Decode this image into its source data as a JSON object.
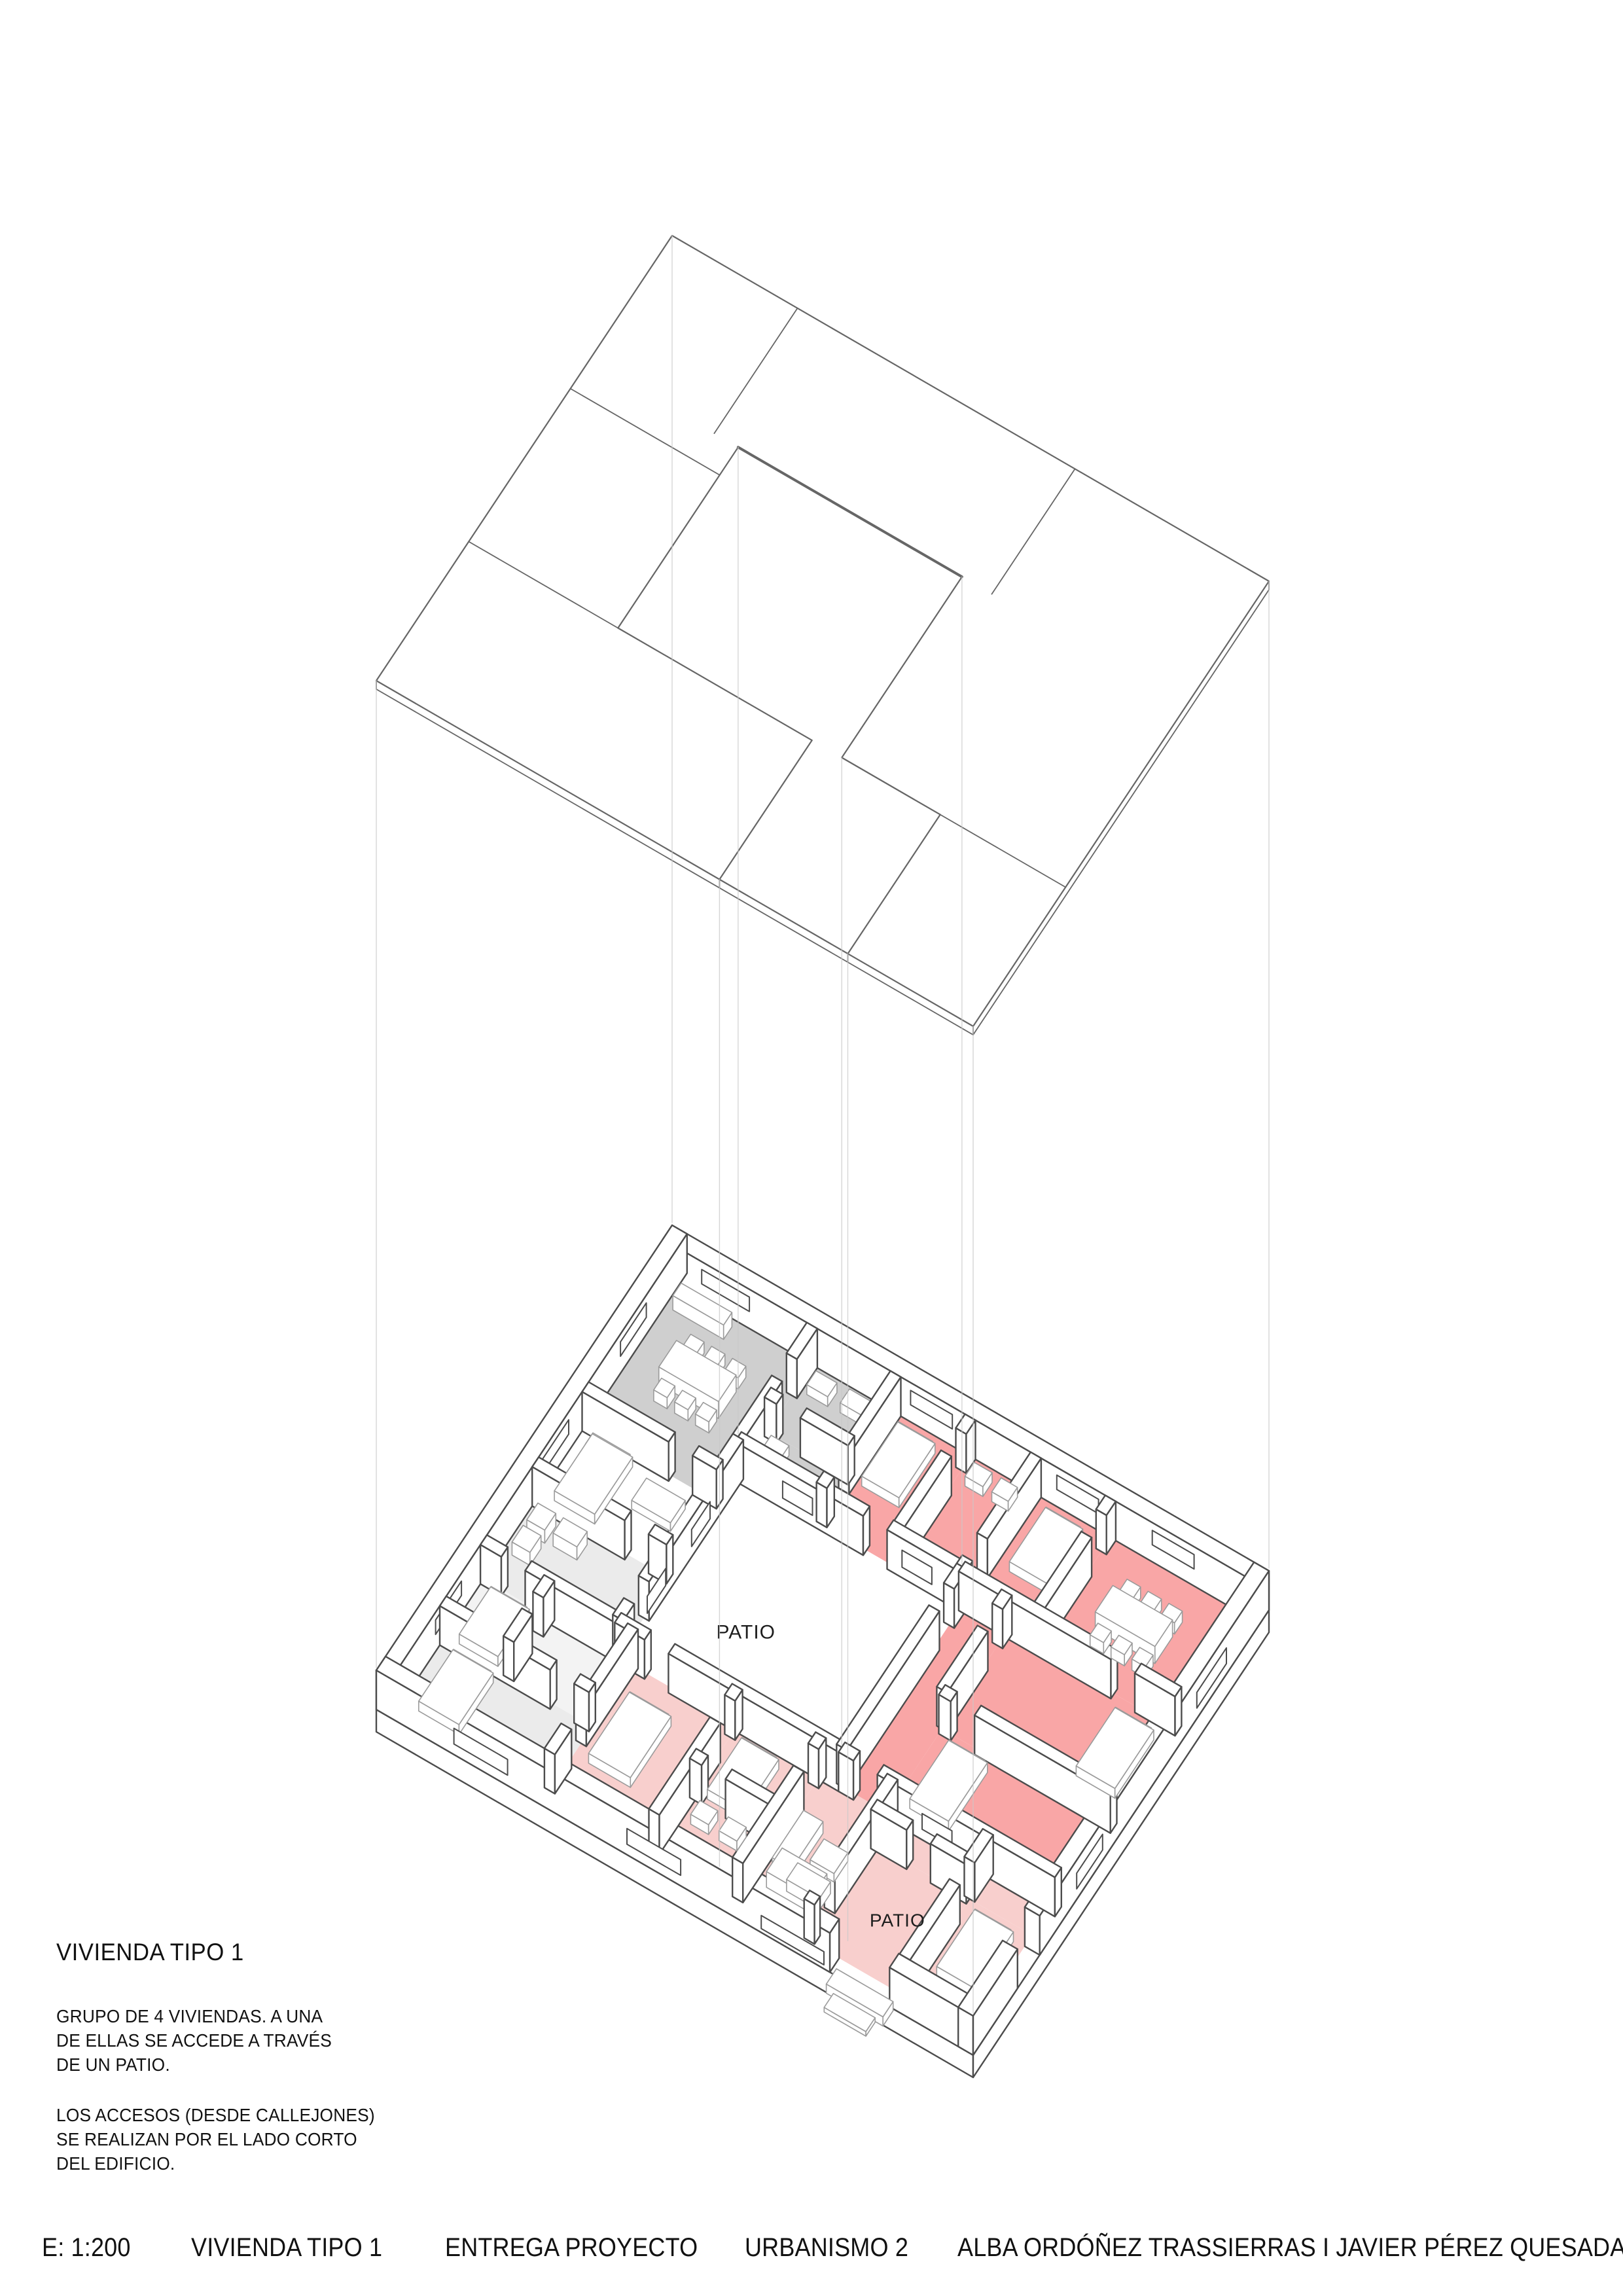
{
  "annotation": {
    "title": "VIVIENDA TIPO 1",
    "body1": "GRUPO DE 4 VIVIENDAS. A UNA\nDE ELLAS SE ACCEDE A TRAVÉS\nDE UN PATIO.",
    "body2": "LOS ACCESOS (DESDE CALLEJONES)\nSE REALIZAN POR EL LADO CORTO\nDEL EDIFICIO."
  },
  "footer": {
    "items": [
      "E: 1:200",
      "VIVIENDA TIPO 1",
      "ENTREGA PROYECTO",
      "URBANISMO 2",
      "ALBA ORDÓÑEZ TRASSIERRAS I JAVIER PÉREZ QUESADA"
    ]
  },
  "labels": {
    "patio_main": "PATIO",
    "patio_entry": "PATIO"
  },
  "colors": {
    "wall_line": "#4c4c4c",
    "roof_line": "#666666",
    "furniture_line": "#9b9b9b",
    "projection_line": "#c9c9c9",
    "floor_gray": "#cfcfcf",
    "floor_lightgray": "#ebebeb",
    "floor_lightgray2": "#f3f3f3",
    "floor_red": "#f9a6a6",
    "floor_pink": "#f8cfcd",
    "paper": "#ffffff",
    "text": "#1d1d1d"
  },
  "scene": {
    "proj": {
      "origin": [
        1027,
        1932
      ],
      "ax": [
        45.6,
        26.4
      ],
      "ay": [
        -28.25,
        42.5
      ],
      "roof_rise": 1572,
      "wall_h": 60,
      "slab": 34
    },
    "roof": {
      "outer": [
        [
          0,
          0
        ],
        [
          20,
          0
        ],
        [
          20,
          16
        ],
        [
          0,
          16
        ]
      ],
      "hole": [
        [
          5,
          4.5
        ],
        [
          12.5,
          4.5
        ],
        [
          12.5,
          11
        ],
        [
          15.8,
          11
        ],
        [
          15.8,
          16
        ],
        [
          11.5,
          16
        ],
        [
          11.5,
          11
        ],
        [
          5,
          11
        ]
      ],
      "divisions": [
        [
          4.2,
          0,
          4.2,
          4.5
        ],
        [
          0,
          5.5,
          5,
          5.5
        ],
        [
          0,
          11,
          5,
          11
        ],
        [
          13.5,
          0,
          13.5,
          4.5
        ],
        [
          12.5,
          11,
          20,
          11
        ]
      ],
      "heavy_edge": [
        5,
        4.5,
        12.5,
        4.5
      ],
      "thick": 13
    },
    "verticals": [
      [
        0,
        0
      ],
      [
        20,
        0
      ],
      [
        0,
        16
      ],
      [
        20,
        16
      ],
      [
        5,
        4.5
      ],
      [
        12.5,
        4.5
      ],
      [
        11.5,
        16
      ],
      [
        15.8,
        16
      ],
      [
        12.5,
        11
      ]
    ],
    "floors": [
      {
        "c": "floor_gray",
        "r": [
          0.5,
          0.5,
          5,
          5.5
        ]
      },
      {
        "c": "floor_gray",
        "r": [
          5,
          0.5,
          7.8,
          2.9
        ]
      },
      {
        "c": "floor_gray",
        "r": [
          5,
          2.9,
          7.8,
          4.5
        ]
      },
      {
        "c": "floor_lightgray",
        "r": [
          0.5,
          8.2,
          5,
          11
        ]
      },
      {
        "c": "floor_lightgray2",
        "r": [
          0.5,
          11,
          5.5,
          13.2
        ]
      },
      {
        "c": "floor_lightgray",
        "r": [
          0.5,
          13.2,
          5.5,
          15.5
        ]
      },
      {
        "c": "floor_red",
        "r": [
          7.8,
          0.5,
          10.3,
          4.5
        ]
      },
      {
        "c": "floor_red",
        "r": [
          10.3,
          0.5,
          12.5,
          4.5
        ]
      },
      {
        "c": "floor_red",
        "r": [
          12.5,
          0.5,
          15,
          4.5
        ]
      },
      {
        "c": "floor_red",
        "r": [
          15,
          0.5,
          19.5,
          4.5
        ]
      },
      {
        "c": "floor_red",
        "r": [
          12.5,
          4.5,
          14,
          11
        ]
      },
      {
        "c": "floor_red",
        "r": [
          14,
          4.5,
          19.5,
          8
        ]
      },
      {
        "c": "floor_red",
        "r": [
          14,
          8,
          19.5,
          11
        ]
      },
      {
        "c": "floor_pink",
        "r": [
          5.5,
          11,
          9,
          15.5
        ]
      },
      {
        "c": "floor_pink",
        "r": [
          9,
          11,
          11.8,
          13.4
        ]
      },
      {
        "c": "floor_pink",
        "r": [
          9,
          13.4,
          11.8,
          15.5
        ]
      },
      {
        "c": "floor_pink",
        "r": [
          11.8,
          11,
          14.2,
          15.5
        ]
      },
      {
        "c": "floor_pink",
        "r": [
          14.2,
          11,
          19.5,
          12
        ]
      },
      {
        "c": "floor_pink",
        "r": [
          14.2,
          12,
          17.4,
          15.5
        ]
      },
      {
        "c": "floor_pink",
        "r": [
          17.4,
          12,
          19.5,
          15.5
        ]
      }
    ],
    "walls": [
      [
        0,
        0.25,
        20,
        0.25,
        0.5
      ],
      [
        0.25,
        0,
        0.25,
        16,
        0.5
      ],
      [
        19.75,
        0,
        19.75,
        12.4,
        0.5
      ],
      [
        19.75,
        13.6,
        19.75,
        16,
        0.5
      ],
      [
        0,
        15.75,
        15.2,
        15.75,
        0.5
      ],
      [
        17.2,
        15.75,
        20,
        15.75,
        0.5
      ],
      [
        5,
        4.5,
        9.3,
        4.5,
        0.35
      ],
      [
        10.1,
        4.5,
        12.5,
        4.5,
        0.35
      ],
      [
        5,
        11,
        6.0,
        11,
        0.35
      ],
      [
        6.8,
        11,
        12.5,
        11,
        0.35
      ],
      [
        5,
        4.5,
        5,
        9.6,
        0.35
      ],
      [
        5,
        10.4,
        5,
        11,
        0.35
      ],
      [
        12.5,
        4.5,
        12.5,
        5.2,
        0.35
      ],
      [
        12.5,
        6.0,
        12.5,
        11,
        0.35
      ],
      [
        5,
        0.5,
        5,
        1.6,
        0.35
      ],
      [
        5,
        2.4,
        5,
        4.5,
        0.35
      ],
      [
        0.5,
        5.5,
        3.4,
        5.5,
        0.35
      ],
      [
        4.2,
        5.5,
        5,
        5.5,
        0.35
      ],
      [
        7.8,
        0.5,
        7.8,
        3.3,
        0.35
      ],
      [
        7.8,
        4.1,
        7.8,
        4.5,
        0.35
      ],
      [
        5,
        2.9,
        5.4,
        2.9,
        0.35
      ],
      [
        6.2,
        2.9,
        7.8,
        2.9,
        0.35
      ],
      [
        0.5,
        8.2,
        3.6,
        8.2,
        0.35
      ],
      [
        4.4,
        8.2,
        5,
        8.2,
        0.35
      ],
      [
        0.5,
        11,
        1.2,
        11,
        0.35
      ],
      [
        2.0,
        11,
        5,
        11,
        0.35
      ],
      [
        2.7,
        11,
        2.7,
        11.6,
        0.35
      ],
      [
        2.7,
        12.2,
        2.7,
        13.2,
        0.35
      ],
      [
        0.5,
        13.2,
        4.2,
        13.2,
        0.35
      ],
      [
        5.0,
        13.2,
        5.5,
        13.2,
        0.35
      ],
      [
        5.5,
        11,
        5.5,
        13.8,
        0.35
      ],
      [
        5.5,
        14.6,
        5.5,
        15.5,
        0.35
      ],
      [
        10.3,
        0.5,
        10.3,
        1.0,
        0.35
      ],
      [
        10.3,
        1.8,
        10.3,
        4.5,
        0.35
      ],
      [
        12.5,
        0.5,
        12.5,
        3.4,
        0.35
      ],
      [
        12.5,
        4.2,
        12.5,
        4.5,
        0.35
      ],
      [
        15,
        0.5,
        15,
        1.0,
        0.35
      ],
      [
        15,
        1.8,
        15,
        4.5,
        0.35
      ],
      [
        12.5,
        4.5,
        17.6,
        4.5,
        0.35
      ],
      [
        18.4,
        4.5,
        19.75,
        4.5,
        0.35
      ],
      [
        14,
        4.5,
        14,
        5.0,
        0.35
      ],
      [
        14,
        5.8,
        14,
        8.0,
        0.35
      ],
      [
        14,
        8.0,
        14.4,
        8.0,
        0.35
      ],
      [
        15.2,
        8.0,
        19.75,
        8.0,
        0.35
      ],
      [
        12.5,
        11,
        13.0,
        11,
        0.35
      ],
      [
        13.8,
        11,
        19.75,
        11,
        0.35
      ],
      [
        9.0,
        11,
        9.0,
        11.4,
        0.35
      ],
      [
        9.0,
        12.2,
        9.0,
        15.5,
        0.35
      ],
      [
        11.8,
        11,
        11.8,
        11.4,
        0.35
      ],
      [
        11.8,
        12.2,
        11.8,
        15.5,
        0.35
      ],
      [
        9.0,
        13.4,
        9.4,
        13.4,
        0.35
      ],
      [
        10.2,
        13.4,
        11.8,
        13.4,
        0.35
      ],
      [
        14.2,
        11,
        14.2,
        14.4,
        0.35
      ],
      [
        14.2,
        15.2,
        14.2,
        15.5,
        0.35
      ],
      [
        17.4,
        11,
        17.4,
        12.0,
        0.35
      ],
      [
        17.4,
        12.8,
        17.4,
        15.5,
        0.35
      ],
      [
        14.2,
        12.0,
        15.4,
        12.0,
        0.35
      ],
      [
        16.2,
        12.0,
        17.4,
        12.0,
        0.35
      ]
    ],
    "furniture": [
      [
        1.6,
        2.35,
        2.0,
        0.95,
        26
      ],
      [
        1.75,
        1.82,
        0.45,
        0.42,
        17
      ],
      [
        2.45,
        1.82,
        0.45,
        0.42,
        17
      ],
      [
        3.15,
        1.82,
        0.45,
        0.42,
        17
      ],
      [
        1.75,
        3.4,
        0.45,
        0.42,
        17
      ],
      [
        2.45,
        3.4,
        0.45,
        0.42,
        17
      ],
      [
        3.15,
        3.4,
        0.45,
        0.42,
        17
      ],
      [
        0.75,
        0.72,
        1.7,
        0.45,
        22
      ],
      [
        5.35,
        0.85,
        0.7,
        0.5,
        15
      ],
      [
        6.45,
        0.82,
        0.75,
        0.5,
        15
      ],
      [
        5.3,
        3.2,
        0.6,
        0.45,
        15
      ],
      [
        0.95,
        5.85,
        1.35,
        2.05,
        15
      ],
      [
        1.0,
        5.9,
        1.25,
        0.4,
        20
      ],
      [
        2.95,
        6.15,
        1.3,
        0.8,
        13
      ],
      [
        0.8,
        8.55,
        0.6,
        0.6,
        20
      ],
      [
        0.8,
        9.35,
        0.6,
        0.6,
        20
      ],
      [
        1.65,
        8.55,
        0.8,
        0.55,
        20
      ],
      [
        0.95,
        11.35,
        1.3,
        1.7,
        15
      ],
      [
        1.0,
        11.4,
        1.2,
        0.35,
        19
      ],
      [
        1.05,
        13.55,
        1.35,
        1.85,
        15
      ],
      [
        1.1,
        13.6,
        1.25,
        0.38,
        19
      ],
      [
        8.15,
        0.95,
        1.25,
        1.95,
        15
      ],
      [
        8.2,
        1.0,
        1.15,
        0.38,
        19
      ],
      [
        10.65,
        0.85,
        0.6,
        0.5,
        15
      ],
      [
        11.55,
        0.85,
        0.55,
        0.5,
        15
      ],
      [
        13.1,
        0.95,
        1.25,
        1.95,
        15
      ],
      [
        13.15,
        1.0,
        1.15,
        0.38,
        19
      ],
      [
        16.1,
        2.15,
        2.0,
        0.95,
        26
      ],
      [
        16.25,
        1.62,
        0.45,
        0.42,
        17
      ],
      [
        16.95,
        1.62,
        0.45,
        0.42,
        17
      ],
      [
        17.65,
        1.62,
        0.45,
        0.42,
        17
      ],
      [
        16.25,
        3.2,
        0.45,
        0.42,
        17
      ],
      [
        16.95,
        3.2,
        0.45,
        0.42,
        17
      ],
      [
        17.65,
        3.2,
        0.45,
        0.42,
        17
      ],
      [
        18.0,
        5.1,
        1.3,
        2.1,
        15
      ],
      [
        18.05,
        5.15,
        1.2,
        0.38,
        19
      ],
      [
        14.5,
        8.45,
        1.3,
        2.1,
        15
      ],
      [
        14.55,
        8.5,
        1.2,
        0.38,
        19
      ],
      [
        6.0,
        12.0,
        1.4,
        2.2,
        15
      ],
      [
        6.05,
        12.05,
        1.3,
        0.4,
        19
      ],
      [
        9.45,
        11.5,
        1.25,
        1.85,
        15
      ],
      [
        9.5,
        11.55,
        1.15,
        0.38,
        19
      ],
      [
        9.45,
        13.75,
        0.6,
        0.5,
        15
      ],
      [
        10.4,
        13.75,
        0.6,
        0.5,
        15
      ],
      [
        12.15,
        12.5,
        0.65,
        1.7,
        18
      ],
      [
        12.85,
        13.95,
        1.1,
        0.6,
        18
      ],
      [
        13.05,
        12.85,
        0.8,
        0.75,
        13
      ],
      [
        12.3,
        13.9,
        1.5,
        0.85,
        24
      ],
      [
        17.85,
        12.45,
        1.3,
        2.05,
        15
      ],
      [
        17.9,
        12.5,
        1.2,
        0.38,
        19
      ],
      [
        15.45,
        16.05,
        1.9,
        0.55,
        14
      ],
      [
        15.7,
        16.62,
        1.4,
        0.5,
        7
      ]
    ],
    "openings_h": [
      [
        4.675,
        6.6,
        7.6,
        16,
        42
      ],
      [
        4.675,
        10.6,
        11.6,
        16,
        42
      ],
      [
        16.0,
        2.6,
        4.4,
        16,
        40
      ],
      [
        16.0,
        8.4,
        10.2,
        16,
        40
      ],
      [
        16.0,
        12.9,
        15.0,
        6,
        26
      ],
      [
        0.5,
        1.3,
        2.9,
        26,
        48
      ],
      [
        0.5,
        8.3,
        9.7,
        26,
        48
      ],
      [
        0.5,
        13.2,
        14.6,
        26,
        48
      ],
      [
        0.5,
        16.4,
        17.8,
        26,
        48
      ],
      [
        11.175,
        15.3,
        16.3,
        16,
        40
      ]
    ],
    "openings_v": [
      [
        5.175,
        6.3,
        7.3,
        16,
        42
      ],
      [
        5.175,
        8.7,
        9.7,
        16,
        42
      ],
      [
        20.0,
        2.3,
        3.9,
        16,
        40
      ],
      [
        20.0,
        9.0,
        10.4,
        16,
        40
      ],
      [
        0.5,
        2.2,
        3.6,
        26,
        48
      ],
      [
        0.5,
        6.4,
        7.8,
        26,
        48
      ],
      [
        0.5,
        12.2,
        13.6,
        26,
        48
      ]
    ],
    "label_pos": {
      "patio_main": [
        7.8,
        8.6
      ],
      "patio_entry": [
        16.1,
        13.8
      ]
    },
    "label_size": {
      "patio_main": 30,
      "patio_entry": 28
    }
  }
}
